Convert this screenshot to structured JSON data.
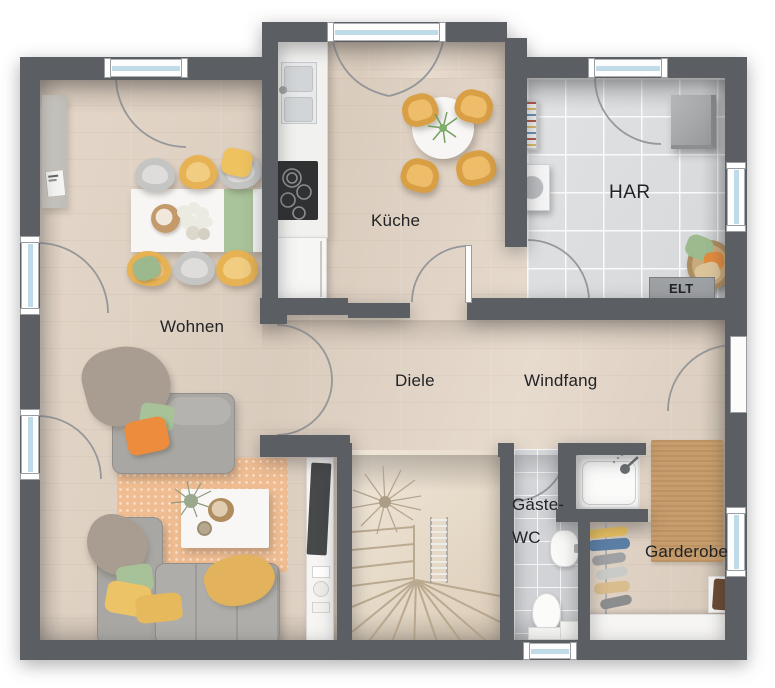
{
  "plan": {
    "labels": {
      "wohnen": "Wohnen",
      "kueche": "Küche",
      "har": "HAR",
      "elt": "ELT",
      "diele": "Diele",
      "windfang": "Windfang",
      "gaeste_wc_line1": "Gäste-",
      "gaeste_wc_line2": "WC",
      "garderobe": "Garderobe"
    },
    "colors": {
      "wall": "#5b5f63",
      "wood_floor": "#ddd0c1",
      "stair_wood": "#e9ddcd",
      "tile_har": "#dbddde",
      "tile_wc": "#d3d5d8",
      "window_glass": "#bfdbe7",
      "sofa_gray": "#a8a7a3",
      "rug_living": "#f0bd92",
      "rug_garderobe": "#c79d6c",
      "chair_yellow": "#e7b253",
      "pillow_orange": "#ed8c3d",
      "pillow_green": "#a7c299",
      "pillow_yellow": "#ecc467",
      "door_arc": "#8e9093"
    }
  }
}
